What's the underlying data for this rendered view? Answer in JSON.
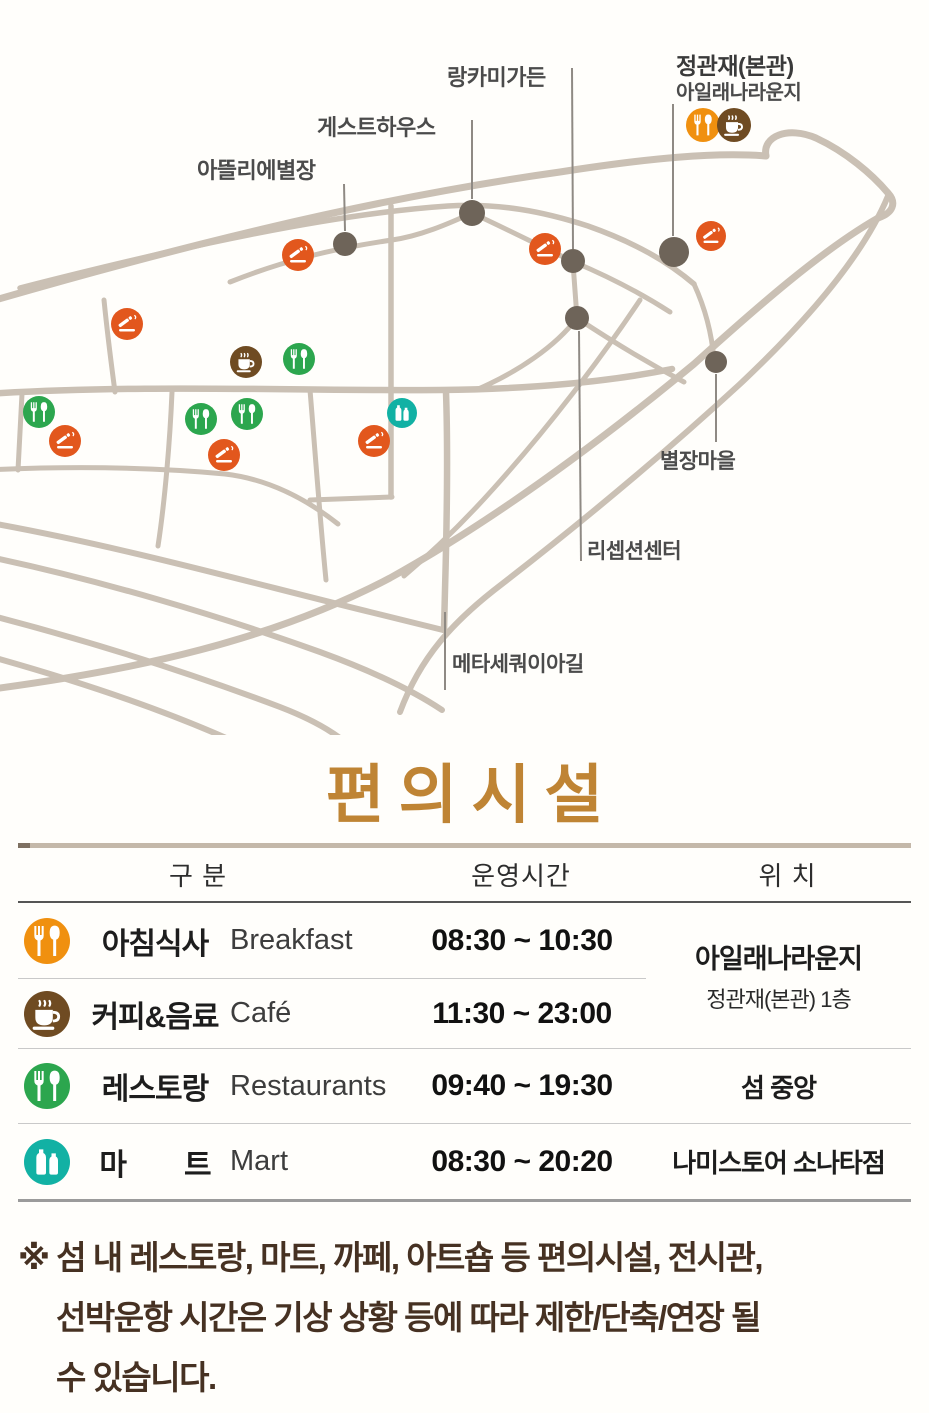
{
  "title": {
    "text": "편의시설",
    "color": "#bf8434"
  },
  "map": {
    "labels": [
      {
        "id": "jeonggwanjae-main",
        "text": "정관재(본관)"
      },
      {
        "id": "isle-lounge",
        "text": "아일래나라운지"
      },
      {
        "id": "langkami-garden",
        "text": "랑카미가든"
      },
      {
        "id": "guesthouse",
        "text": "게스트하우스"
      },
      {
        "id": "atelier-villa",
        "text": "아뜰리에별장"
      },
      {
        "id": "villa-village",
        "text": "별장마을"
      },
      {
        "id": "reception-center",
        "text": "리셉션센터"
      },
      {
        "id": "metasequoia-road",
        "text": "메타세쿼이아길"
      }
    ],
    "marker_colors": {
      "breakfast": "#f0900f",
      "coffee": "#6f4b22",
      "smoking": "#e2571d",
      "restaurant": "#2ca64e",
      "mart": "#12b1a4",
      "dot": "#6e6459"
    },
    "markers": [
      {
        "type": "breakfast",
        "x": 703,
        "y": 125,
        "r": 17
      },
      {
        "type": "coffee",
        "x": 734,
        "y": 125,
        "r": 17
      },
      {
        "type": "coffee",
        "x": 246,
        "y": 362,
        "r": 16
      },
      {
        "type": "smoking",
        "x": 298,
        "y": 255,
        "r": 16
      },
      {
        "type": "smoking",
        "x": 545,
        "y": 249,
        "r": 16
      },
      {
        "type": "smoking",
        "x": 711,
        "y": 236,
        "r": 15
      },
      {
        "type": "smoking",
        "x": 127,
        "y": 324,
        "r": 16
      },
      {
        "type": "smoking",
        "x": 224,
        "y": 455,
        "r": 16
      },
      {
        "type": "smoking",
        "x": 374,
        "y": 441,
        "r": 16
      },
      {
        "type": "smoking",
        "x": 65,
        "y": 441,
        "r": 16
      },
      {
        "type": "restaurant",
        "x": 299,
        "y": 359,
        "r": 16
      },
      {
        "type": "restaurant",
        "x": 201,
        "y": 419,
        "r": 16
      },
      {
        "type": "restaurant",
        "x": 247,
        "y": 414,
        "r": 16
      },
      {
        "type": "restaurant",
        "x": 39,
        "y": 412,
        "r": 16
      },
      {
        "type": "mart",
        "x": 402,
        "y": 413,
        "r": 15
      }
    ],
    "dots": [
      {
        "x": 472,
        "y": 213,
        "r": 13
      },
      {
        "x": 345,
        "y": 244,
        "r": 12
      },
      {
        "x": 573,
        "y": 261,
        "r": 12
      },
      {
        "x": 577,
        "y": 318,
        "r": 12
      },
      {
        "x": 674,
        "y": 252,
        "r": 15
      },
      {
        "x": 716,
        "y": 362,
        "r": 11
      }
    ],
    "pointer_lines": [
      {
        "x1": 572,
        "y1": 68,
        "x2": 573,
        "y2": 249
      },
      {
        "x1": 472,
        "y1": 120,
        "x2": 472,
        "y2": 199
      },
      {
        "x1": 344,
        "y1": 184,
        "x2": 345,
        "y2": 231
      },
      {
        "x1": 673,
        "y1": 104,
        "x2": 673,
        "y2": 236
      },
      {
        "x1": 579,
        "y1": 331,
        "x2": 581,
        "y2": 561
      },
      {
        "x1": 716,
        "y1": 374,
        "x2": 716,
        "y2": 442
      },
      {
        "x1": 445,
        "y1": 612,
        "x2": 445,
        "y2": 690
      }
    ]
  },
  "table": {
    "headers": [
      "구 분",
      "운영시간",
      "위 치"
    ],
    "rows": [
      {
        "type": "breakfast",
        "kr": "아침식사",
        "en": "Breakfast",
        "time": "08:30 ~ 10:30",
        "location": ""
      },
      {
        "type": "coffee",
        "kr": "커피&음료",
        "en": "Café",
        "time": "11:30 ~ 23:00",
        "location": ""
      },
      {
        "type": "restaurant",
        "kr": "레스토랑",
        "en": "Restaurants",
        "time": "09:40 ~ 19:30",
        "location": "섬 중앙"
      },
      {
        "type": "mart",
        "kr": "마　　트",
        "en": "Mart",
        "time": "08:30 ~ 20:20",
        "location": "나미스토어 소나타점"
      }
    ],
    "merged_location": {
      "primary": "아일래나라운지",
      "secondary": "정관재(본관) 1층"
    }
  },
  "note": {
    "lines": [
      "※ 섬 내 레스토랑, 마트, 까페, 아트숍 등 편의시설, 전시관,",
      "선박운항 시간은  기상 상황 등에  따라 제한/단축/연장 될",
      "수 있습니다."
    ]
  }
}
